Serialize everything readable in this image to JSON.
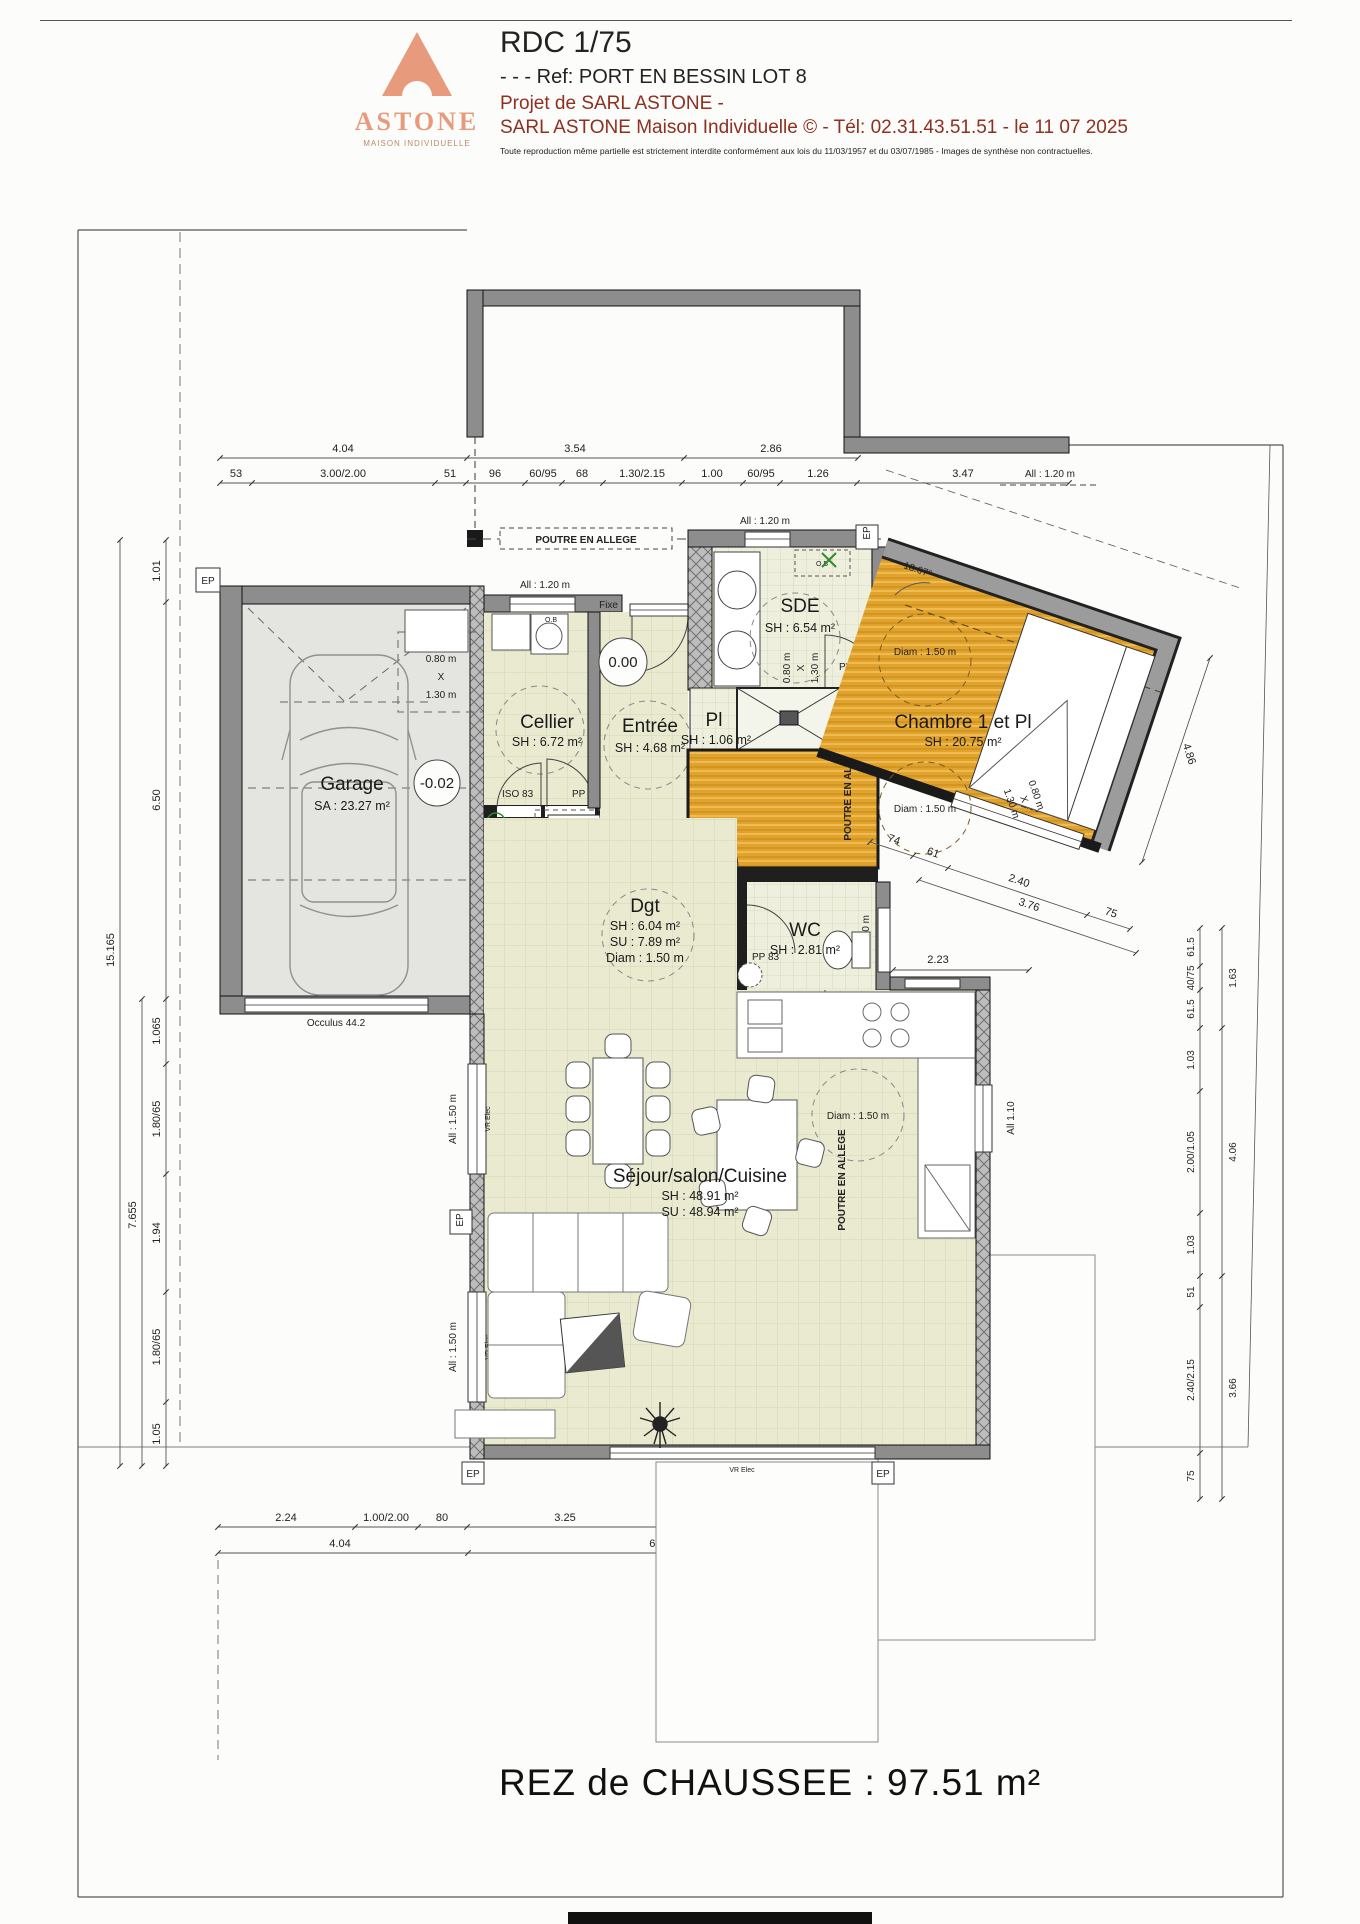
{
  "header": {
    "brand": "ASTONE",
    "brand_subtitle": "MAISON INDIVIDUELLE",
    "title": "RDC 1/75",
    "ref_line": "- - -  Ref: PORT EN BESSIN LOT 8",
    "project_line1": "Projet de SARL ASTONE -",
    "project_line2": "SARL ASTONE Maison Individuelle © - Tél: 02.31.43.51.51 - le 11 07 2025",
    "disclaimer": "Toute reproduction même partielle est strictement interdite conformément aux lois du 11/03/1957 et du 03/07/1985 - Images de synthèse non contractuelles."
  },
  "footer": {
    "title": "REZ de CHAUSSEE : 97.51 m²"
  },
  "rooms": {
    "garage": {
      "name": "Garage",
      "area": "SA : 23.27 m²",
      "level": "-0.02"
    },
    "cellier": {
      "name": "Cellier",
      "area": "SH : 6.72 m²"
    },
    "entree": {
      "name": "Entrée",
      "area": "SH : 4.68 m²",
      "level": "0.00"
    },
    "pl": {
      "name": "Pl",
      "area": "SH : 1.06 m²"
    },
    "sde": {
      "name": "SDE",
      "area": "SH : 6.54 m²"
    },
    "chambre": {
      "name": "Chambre 1 et Pl",
      "area": "SH : 20.75 m²"
    },
    "dgt": {
      "name": "Dgt",
      "sh": "SH : 6.04 m²",
      "su": "SU : 7.89 m²",
      "diam": "Diam : 1.50 m"
    },
    "wc": {
      "name": "WC",
      "area": "SH : 2.81 m²"
    },
    "sejour": {
      "name": "Séjour/salon/Cuisine",
      "sh": "SH : 48.91 m²",
      "su": "SU : 48.94 m²"
    }
  },
  "labels": {
    "poutre": "POUTRE EN ALLEGE",
    "fixe": "Fixe",
    "ep": "EP",
    "ob": "O.B",
    "iso83": "ISO 83",
    "pp83": "PP 83",
    "vr_elec": "VR Elec",
    "occulus": "Occulus 44.2",
    "duo1": "DUO",
    "duo2": "EXTENSA",
    "duo3": "ALFEA",
    "angle": "18.67°",
    "diam150": "Diam : 1.50 m",
    "all120": "All : 1.20 m",
    "all140": "All : 1.40 m",
    "all150": "All : 1.50 m",
    "all110": "All 1.10",
    "all110b": "All : 1.10 m",
    "w080": "0.80 m",
    "wx": "X",
    "w130": "1.30 m"
  },
  "dims": {
    "top1": [
      "4.04",
      "3.54",
      "2.86"
    ],
    "top2": [
      "53",
      "3.00/2.00",
      "51",
      "96",
      "60/95",
      "68",
      "1.30/2.15",
      "1.00",
      "60/95",
      "1.26",
      "3.47"
    ],
    "left_outer": "15.165",
    "left_mid": "7.655",
    "left_inner": [
      "1.01",
      "6.50",
      "1.065",
      "1.80/65",
      "1.94",
      "1.80/65",
      "1.05"
    ],
    "right_inner": [
      "61.5",
      "40/75",
      "61.5",
      "1.03",
      "2.00/1.05",
      "1.03",
      "51",
      "2.40/2.15",
      "75"
    ],
    "right_outer": [
      "1.63",
      "4.06",
      "3.66"
    ],
    "right_top": "4.86",
    "chambre_row": [
      "74",
      "61",
      "2.40",
      "75"
    ],
    "chambre_total": "3.76",
    "wc_dim": "2.23",
    "bottom1": [
      "2.24",
      "1.00/2.00",
      "80",
      "3.25",
      "2.40/2.15",
      "75",
      "29",
      "90/1.05",
      "1.04"
    ],
    "bottom2": [
      "4.04",
      "6.40",
      "2.23"
    ],
    "stairs": [
      "1",
      "2",
      "3",
      "4",
      "5",
      "6",
      "7",
      "8",
      "9"
    ]
  },
  "colors": {
    "accent_orange_floor": "#e2a32c",
    "pale_floor": "#e9ead0",
    "garage_floor": "#e4e4e1",
    "brand_salmon": "#e89b7c",
    "header_red": "#8e2f1f",
    "green_mark": "#2e8b2e"
  }
}
